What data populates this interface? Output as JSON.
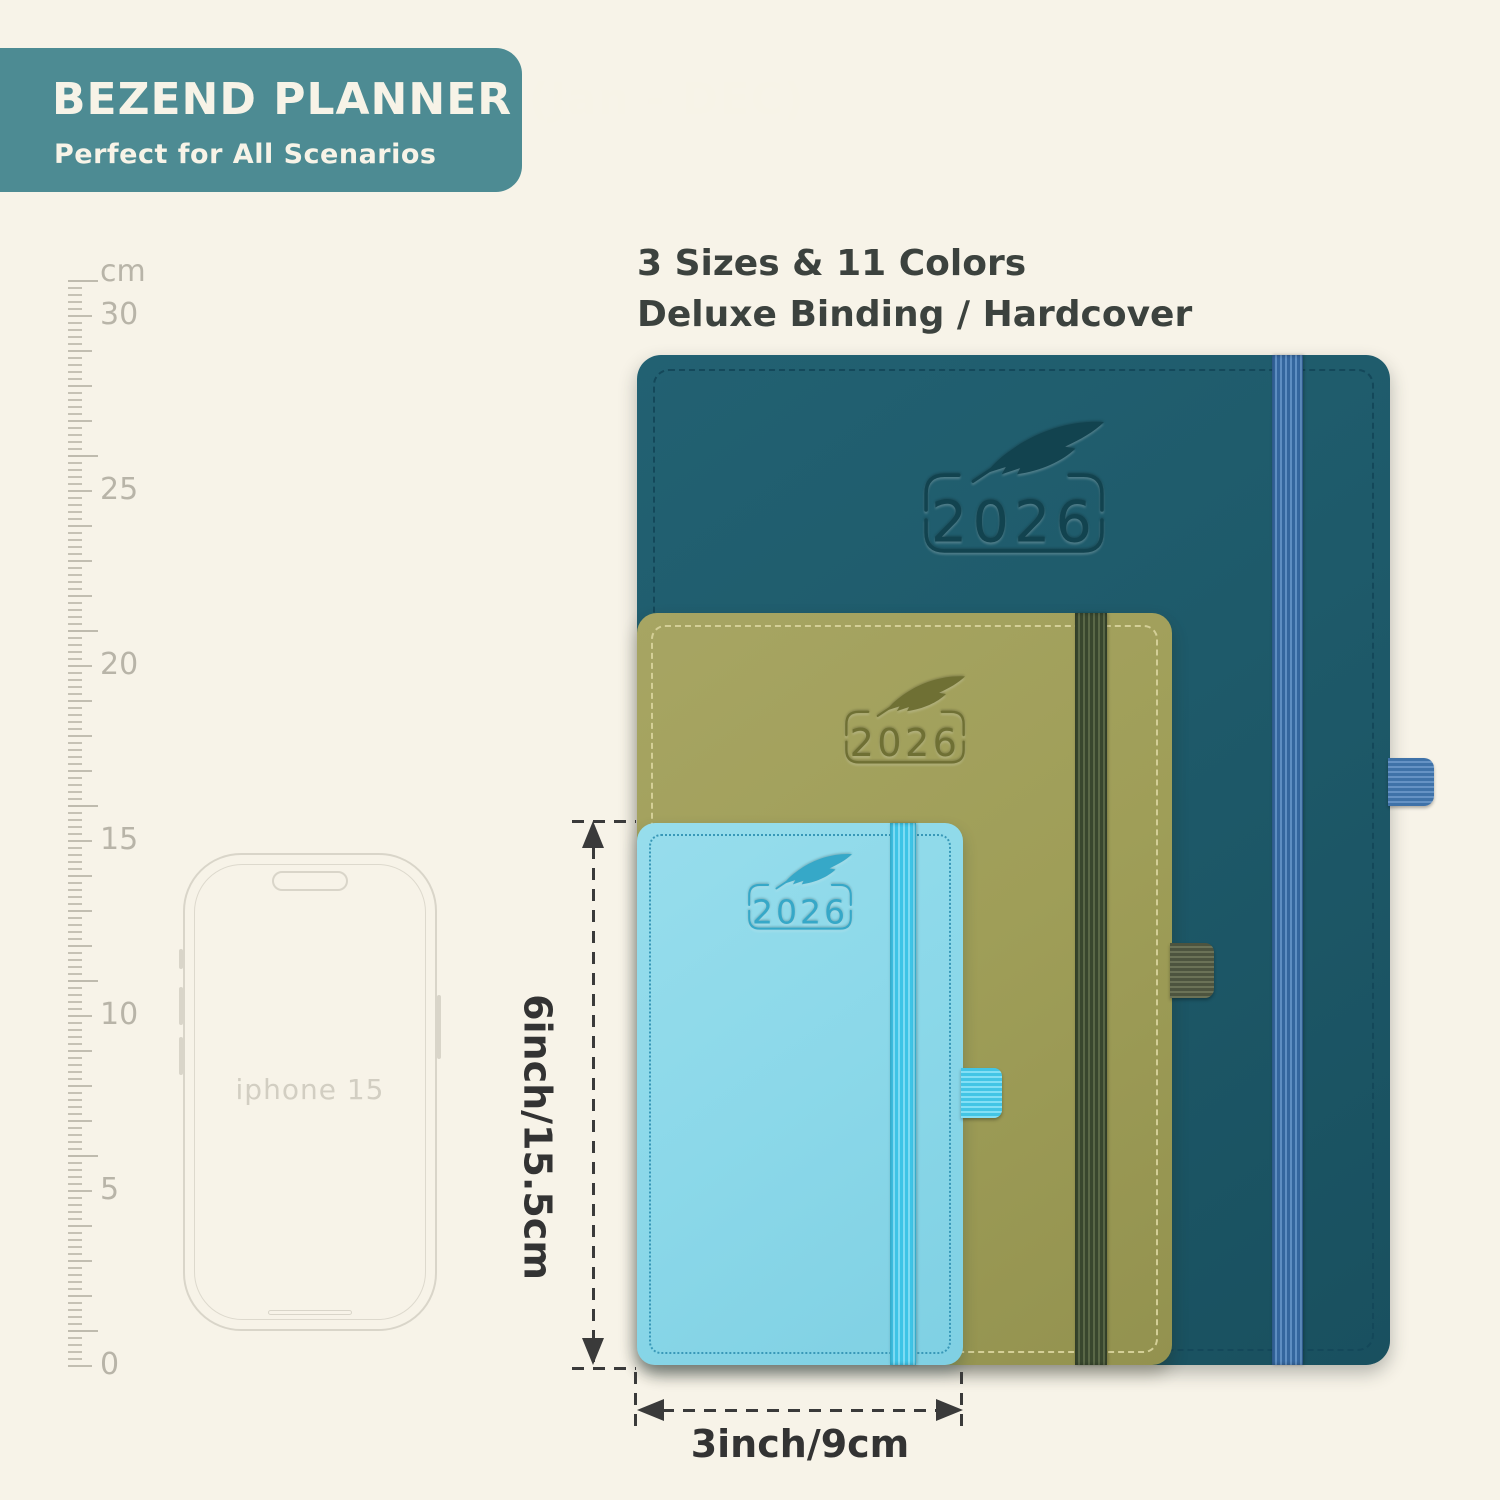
{
  "page": {
    "background_color": "#f7f3e8"
  },
  "banner": {
    "title": "BEZEND PLANNER (Jan - DEC)",
    "subtitle": "Perfect for All Scenarios",
    "bg_color": "#4d8b93",
    "text_color": "#f7f3e7"
  },
  "features": {
    "line1": "3 Sizes & 11 Colors",
    "line2": "Deluxe Binding / Hardcover"
  },
  "ruler": {
    "unit": "cm",
    "marks": [
      "30",
      "25",
      "20",
      "15",
      "10",
      "5",
      "0"
    ]
  },
  "phone": {
    "label": "iphone 15"
  },
  "planners": {
    "large": {
      "year": "2026",
      "cover_color": "#1e5a6a",
      "band_color": "#34669e"
    },
    "medium": {
      "year": "2026",
      "cover_color": "#9f9e58",
      "band_color": "#39472e"
    },
    "small": {
      "year": "2026",
      "cover_color": "#8bd8e9",
      "band_color": "#3ec4e6"
    }
  },
  "dimensions": {
    "height_label": "6inch/15.5cm",
    "width_label": "3inch/9cm"
  }
}
